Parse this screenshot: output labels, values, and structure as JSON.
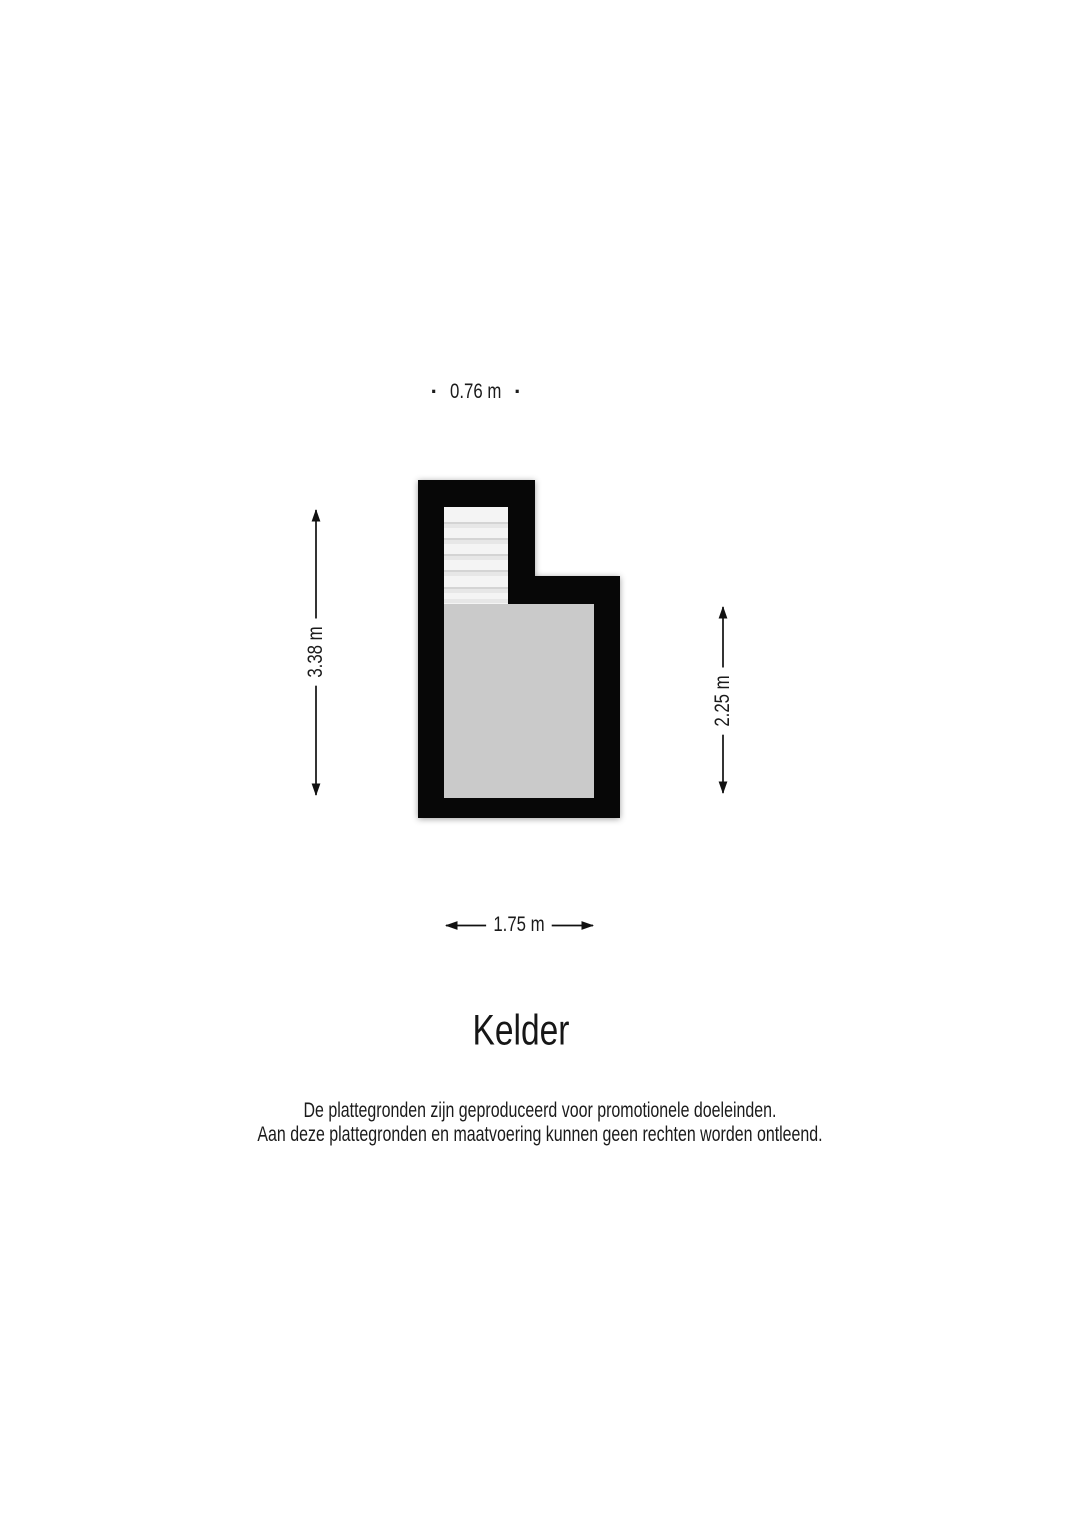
{
  "title": {
    "label": "Kelder"
  },
  "floor_plan": {
    "type": "basement floor plan",
    "colors": {
      "wall": "#070707",
      "room_fill": "#cacaca",
      "stairs_fill": "#f4f4f4",
      "stair_line": "#d4d4d4",
      "arrow": "#111111"
    },
    "dimensions": {
      "width_top": {
        "label": "0.76 m",
        "dot": "·"
      },
      "height_left": {
        "label": "3.38 m"
      },
      "height_right": {
        "label": "2.25 m"
      },
      "width_bottom": {
        "label": "1.75 m"
      }
    }
  },
  "disclaimer": {
    "line1": "De plattegronden zijn geproduceerd voor promotionele doeleinden.",
    "line2": "Aan deze plattegronden en maatvoering kunnen geen rechten worden ontleend."
  }
}
